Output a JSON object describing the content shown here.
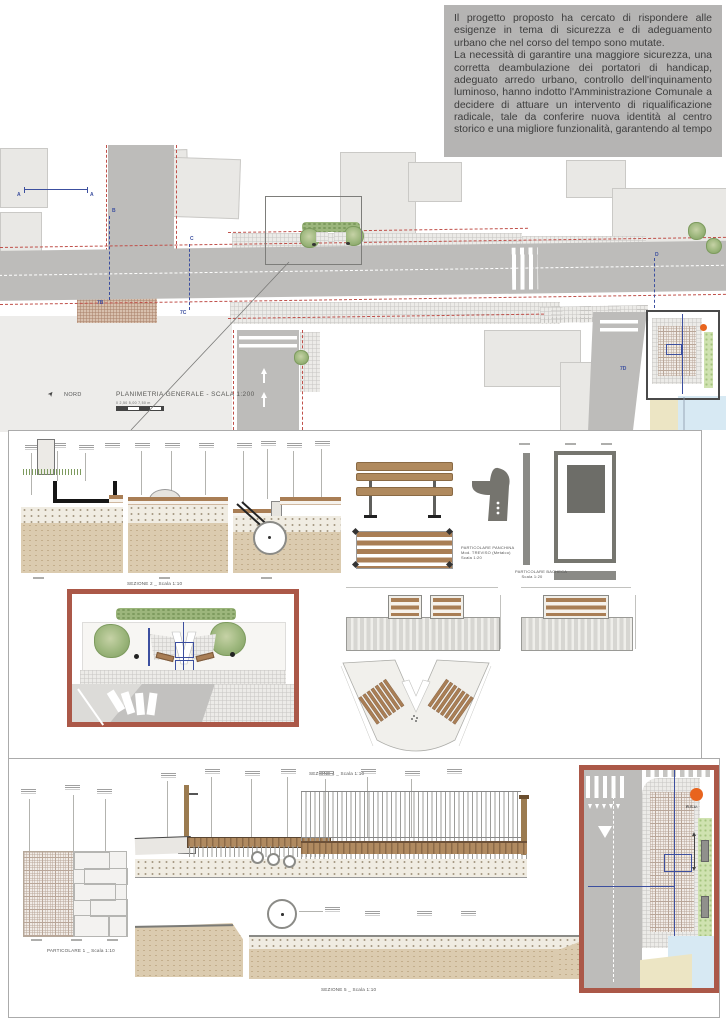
{
  "intro": {
    "p1": "Il progetto proposto ha cercato di rispondere alle esigenze in tema di sicurezza e di adeguamento urbano che nel corso del tempo sono mutate.",
    "p2": "La necessità di garantire una maggiore sicurezza, una corretta deambulazione dei portatori di handicap, adeguato arredo urbano, controllo dell'inquinamento luminoso, hanno indotto l'Amministrazione Comunale a decidere di attuare un intervento di riqualificazione radicale, tale da conferire nuova identità al centro storico e una migliore funzionalità, garantendo al tempo"
  },
  "plan": {
    "north_label": "NORD",
    "title": "PLANIMETRIA GENERALE - SCALA 1:200",
    "scale_text": "0   2,50   5,00   7,50 m",
    "markers": {
      "a1": "A",
      "a2": "A",
      "b": "B",
      "b7": "7B",
      "c": "C",
      "c7": "7C",
      "d": "D",
      "d7": "7D"
    }
  },
  "middle_panel": {
    "sections_caption": "SEZIONE 2 _ Scala 1:10",
    "bench_label_line1": "PARTICOLARE PANCHINA",
    "bench_label_line2": "Mod. TREVISO (Metalco)",
    "bench_label_line3": "Scala 1:20",
    "bacheca_label_line1": "PARTICOLARE BACHECA",
    "bacheca_label_line2": "Scala 1:20"
  },
  "bottom_panel": {
    "sezione4_caption": "SEZIONE 4 _ Scala 1:10",
    "sezione5_caption": "SEZIONE 5 _ Scala 1:10",
    "particolare1_caption": "PARTICOLARE 1 _ Scala 1:10",
    "rsu_label": "R.S.U."
  },
  "colors": {
    "textbox_bg": "#b5b4b3",
    "text_dark": "#3d3d3d",
    "road_gray": "#bdbcba",
    "building_gray": "#e9e8e5",
    "accent_red_border": "#ab5848",
    "dashed_red": "#c0504a",
    "marker_blue": "#3c4f9f",
    "wood_brown": "#a97e55",
    "soil_beige": "#dbcbaf",
    "orange_marker": "#e8641e",
    "water_blue": "#d7e9f3",
    "sand_beige": "#ece5c4",
    "green_vegetation": "#9cb67c"
  }
}
